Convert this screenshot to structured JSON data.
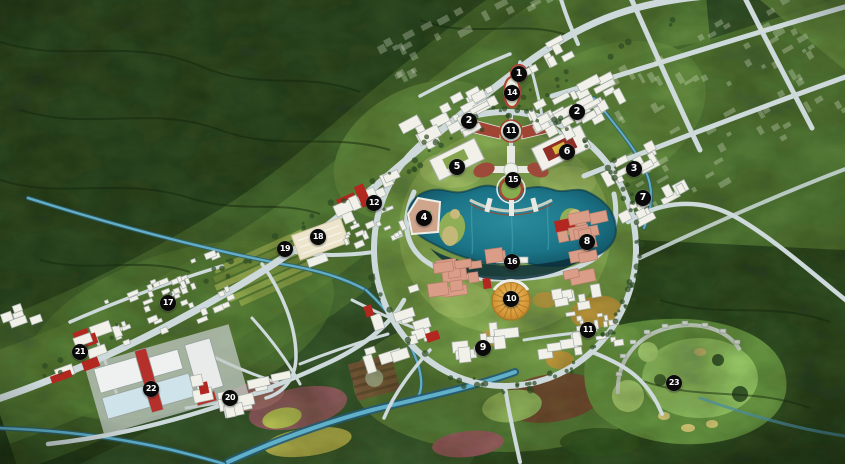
{
  "map": {
    "title": "new-town-masterplan-aerial",
    "palette": {
      "terrain_dark": "#243c1d",
      "terrain_mid": "#3c5c2e",
      "field_light": "#5c8139",
      "corridor_green": "#6a9142",
      "park_ring": "#7da44c",
      "park_inner": "#94b65a",
      "golf_green": "#a9d472",
      "road": "#cdd9db",
      "lake_mid": "#1b7487",
      "lake_deep": "#0d4454",
      "river": "#63aec4",
      "building_white": "#f1f1ea",
      "building_pink": "#d99d88",
      "accent_red": "#b2271f",
      "roof_blue": "#cfe3ea",
      "cream": "#ece4cb",
      "dome_orange": "#d99a3a",
      "marker_bg": "#0a0a0a",
      "marker_text": "#ffffff"
    },
    "markers": [
      {
        "label": "1",
        "x": 519,
        "y": 74
      },
      {
        "label": "14",
        "x": 512,
        "y": 93
      },
      {
        "label": "2",
        "x": 469,
        "y": 121
      },
      {
        "label": "2",
        "x": 577,
        "y": 112
      },
      {
        "label": "11",
        "x": 511,
        "y": 131
      },
      {
        "label": "6",
        "x": 567,
        "y": 152
      },
      {
        "label": "5",
        "x": 457,
        "y": 167
      },
      {
        "label": "15",
        "x": 513,
        "y": 180
      },
      {
        "label": "3",
        "x": 634,
        "y": 169
      },
      {
        "label": "7",
        "x": 643,
        "y": 198
      },
      {
        "label": "12",
        "x": 374,
        "y": 203
      },
      {
        "label": "4",
        "x": 424,
        "y": 218
      },
      {
        "label": "18",
        "x": 318,
        "y": 237
      },
      {
        "label": "19",
        "x": 285,
        "y": 249
      },
      {
        "label": "8",
        "x": 587,
        "y": 242
      },
      {
        "label": "16",
        "x": 512,
        "y": 262
      },
      {
        "label": "10",
        "x": 511,
        "y": 299
      },
      {
        "label": "17",
        "x": 168,
        "y": 303
      },
      {
        "label": "11",
        "x": 588,
        "y": 330
      },
      {
        "label": "9",
        "x": 483,
        "y": 348
      },
      {
        "label": "21",
        "x": 80,
        "y": 352
      },
      {
        "label": "22",
        "x": 151,
        "y": 389
      },
      {
        "label": "20",
        "x": 230,
        "y": 398
      },
      {
        "label": "23",
        "x": 674,
        "y": 383
      }
    ],
    "clusters": [
      {
        "id": "res-north-west",
        "box": [
          400,
          96,
          104,
          46
        ],
        "rot": -28,
        "n": 26,
        "s": [
          5,
          12
        ],
        "c": "white",
        "a": 0.03,
        "seed": 11
      },
      {
        "id": "res-north-east",
        "box": [
          528,
          80,
          112,
          52
        ],
        "rot": -28,
        "n": 30,
        "s": [
          5,
          12
        ],
        "c": "white",
        "a": 0.05,
        "seed": 22
      },
      {
        "id": "res-east-3",
        "box": [
          600,
          152,
          62,
          30
        ],
        "rot": -28,
        "n": 11,
        "s": [
          5,
          11
        ],
        "c": "white",
        "a": 0,
        "seed": 33
      },
      {
        "id": "res-east-7",
        "box": [
          616,
          188,
          76,
          30
        ],
        "rot": -28,
        "n": 11,
        "s": [
          5,
          11
        ],
        "c": "white",
        "a": 0,
        "seed": 44
      },
      {
        "id": "institute-12",
        "box": [
          332,
          178,
          86,
          44
        ],
        "rot": -24,
        "n": 10,
        "s": [
          7,
          14
        ],
        "c": "white",
        "a": 0.1,
        "seed": 55
      },
      {
        "id": "village-12-south",
        "box": [
          342,
          214,
          64,
          34
        ],
        "rot": -24,
        "n": 18,
        "s": [
          3,
          6
        ],
        "c": "white",
        "a": 0,
        "seed": 66
      },
      {
        "id": "campus-pink-8",
        "box": [
          558,
          206,
          58,
          82
        ],
        "rot": -12,
        "n": 13,
        "s": [
          7,
          14
        ],
        "c": "pink",
        "a": 0.08,
        "seed": 77
      },
      {
        "id": "campus-pink-south",
        "box": [
          418,
          252,
          92,
          56
        ],
        "rot": -8,
        "n": 13,
        "s": [
          7,
          14
        ],
        "c": "pink",
        "a": 0.05,
        "seed": 88
      },
      {
        "id": "res-9",
        "box": [
          440,
          324,
          82,
          44
        ],
        "rot": -6,
        "n": 10,
        "s": [
          6,
          13
        ],
        "c": "white",
        "a": 0.05,
        "seed": 99
      },
      {
        "id": "res-11-south",
        "box": [
          560,
          308,
          64,
          44
        ],
        "rot": -8,
        "n": 16,
        "s": [
          3,
          6
        ],
        "c": "white",
        "a": 0,
        "seed": 110
      },
      {
        "id": "res-south-east",
        "box": [
          552,
          282,
          62,
          34
        ],
        "rot": -10,
        "n": 7,
        "s": [
          6,
          11
        ],
        "c": "white",
        "a": 0,
        "seed": 121
      },
      {
        "id": "res-south-west",
        "box": [
          352,
          292,
          92,
          72
        ],
        "rot": -18,
        "n": 14,
        "s": [
          6,
          12
        ],
        "c": "white",
        "a": 0.15,
        "seed": 132
      },
      {
        "id": "grid-17",
        "box": [
          104,
          268,
          132,
          66
        ],
        "rot": -22,
        "n": 42,
        "s": [
          3,
          6
        ],
        "c": "white",
        "a": 0.02,
        "seed": 143
      },
      {
        "id": "courtyards-20",
        "box": [
          188,
          364,
          112,
          56
        ],
        "rot": -12,
        "n": 12,
        "s": [
          7,
          13
        ],
        "c": "white",
        "a": 0.25,
        "seed": 154
      },
      {
        "id": "sheds-21",
        "box": [
          42,
          328,
          86,
          44
        ],
        "rot": -20,
        "n": 9,
        "s": [
          7,
          12
        ],
        "c": "white",
        "a": 0.3,
        "seed": 165
      },
      {
        "id": "res-se-court",
        "box": [
          536,
          334,
          50,
          30
        ],
        "rot": -8,
        "n": 5,
        "s": [
          7,
          11
        ],
        "c": "white",
        "a": 0,
        "seed": 176
      },
      {
        "id": "north-gate-blocks",
        "box": [
          516,
          44,
          58,
          30
        ],
        "rot": -28,
        "n": 7,
        "s": [
          5,
          10
        ],
        "c": "white",
        "a": 0,
        "seed": 187
      },
      {
        "id": "left-edge-sheds",
        "box": [
          0,
          300,
          46,
          34
        ],
        "rot": -20,
        "n": 5,
        "s": [
          5,
          9
        ],
        "c": "white",
        "a": 0.2,
        "seed": 198
      },
      {
        "id": "ghost-footprints-ne",
        "box": [
          600,
          10,
          230,
          170
        ],
        "rot": -30,
        "n": 70,
        "s": [
          3,
          7
        ],
        "c": "ghost",
        "a": 0,
        "seed": 209
      },
      {
        "id": "ghost-footprints-top",
        "box": [
          370,
          0,
          190,
          52
        ],
        "rot": -28,
        "n": 26,
        "s": [
          4,
          8
        ],
        "c": "ghost",
        "a": 0,
        "seed": 220
      }
    ]
  }
}
